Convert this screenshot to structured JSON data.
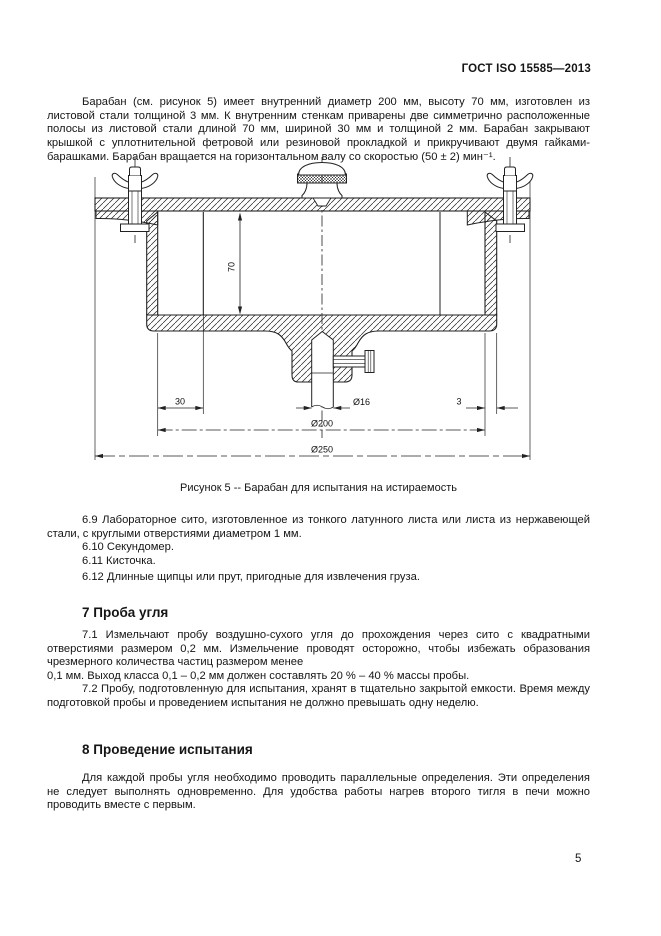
{
  "header": {
    "title": "ГОСТ ISO 15585—2013"
  },
  "intro_paragraph": "Барабан (см. рисунок 5) имеет внутренний диаметр 200 мм, высоту 70 мм, изготовлен из листовой стали толщиной 3 мм. К внутренним стенкам приварены две симметрично расположенные полосы из листовой стали длиной 70 мм, шириной 30 мм и толщиной 2 мм. Барабан закрывают крышкой с уплотнительной фетровой или резиновой прокладкой и прикручивают двумя гайками-барашками. Барабан вращается на горизонтальном валу со скоростью (50 ± 2) мин⁻¹.",
  "figure": {
    "caption": "Рисунок 5 -- Барабан для испытания на истираемость",
    "dims": {
      "inner_height": "70",
      "strip_width": "30",
      "shaft_dia": "Ø16",
      "wall_thickness": "3",
      "inner_dia": "Ø200",
      "outer_dia": "Ø250"
    }
  },
  "items": {
    "i69": "6.9 Лабораторное сито, изготовленное из тонкого латунного листа или листа из нержавеющей стали, с круглыми отверстиями диаметром 1 мм.",
    "i610": "6.10 Секундомер.",
    "i611": "6.11 Кисточка.",
    "i612": "6.12 Длинные щипцы или прут, пригодные для извлечения груза."
  },
  "section7": {
    "heading": "7 Проба угля",
    "p71a": "7.1 Измельчают пробу воздушно-сухого угля до прохождения через сито с квадратными отверстиями размером 0,2 мм. Измельчение проводят осторожно, чтобы избежать образования чрезмерного количества частиц размером менее",
    "p71b": "0,1 мм. Выход класса 0,1 – 0,2 мм должен составлять 20 % – 40 % массы пробы.",
    "p72": "7.2 Пробу, подготовленную для испытания, хранят в тщательно закрытой емкости. Время между подготовкой пробы и проведением испытания не должно превышать одну неделю."
  },
  "section8": {
    "heading": "8 Проведение испытания",
    "p": "Для каждой пробы угля необходимо проводить параллельные определения. Эти определения не следует выполнять одновременно. Для удобства работы нагрев второго тигля в печи можно проводить вместе с первым."
  },
  "footer": {
    "page_number": "5"
  }
}
